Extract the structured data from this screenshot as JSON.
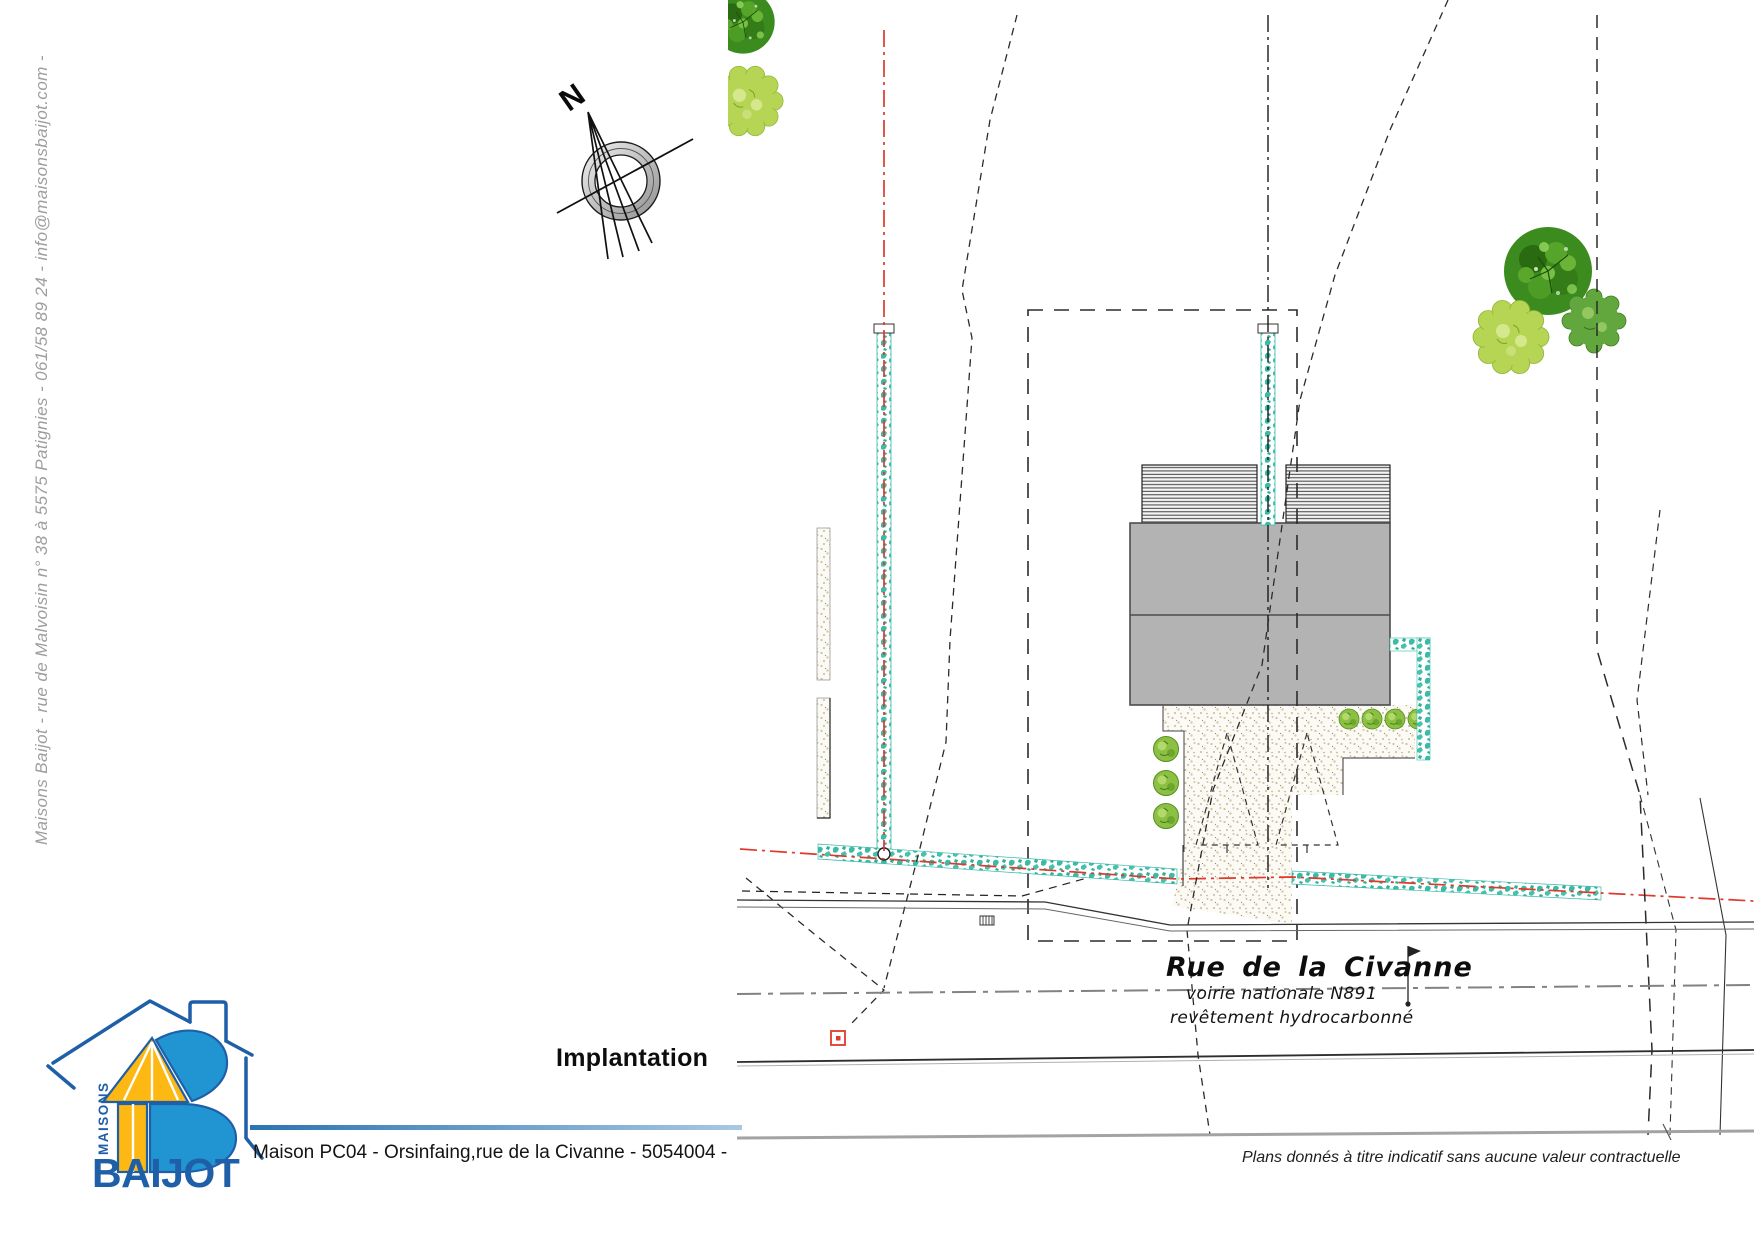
{
  "sidebar": {
    "contact_line": "Maisons Baijot - rue de Malvoisin n° 38 à 5575 Patignies - 061/58 89 24 - info@maisonsbaijot.com -"
  },
  "logo": {
    "brand_top": "MAISONS",
    "brand_name": "BAIJOT",
    "outline_blue": "#1f5fa8",
    "fill_blue": "#2095d2",
    "fill_yellow": "#fdb813"
  },
  "title": {
    "label": "Implantation"
  },
  "footer": {
    "project_line": "Maison PC04 - Orsinfaing,rue de la Civanne - 5054004 -",
    "divider_gradient_left": "#2b74b3",
    "divider_gradient_right": "#a9c9e2",
    "disclaimer": "Plans donnés à titre indicatif sans aucune valeur contractuelle"
  },
  "plan": {
    "north_label": "N",
    "street": {
      "name": "Rue de la Civanne",
      "classification": "voirie nationale N891",
      "surface": "revêtement hydrocarbonné"
    },
    "colors": {
      "hedge_teal": "#3bbaa6",
      "boundary_red": "#e0382c",
      "building_gray": "#b3b3b3",
      "road_centerline_gray": "#828282",
      "stipple_dot": "#cdc1a2",
      "tree_dark_green": "#3c8b1e",
      "tree_yellow_green": "#b7d554",
      "tree_mid_green": "#61a73e"
    }
  }
}
